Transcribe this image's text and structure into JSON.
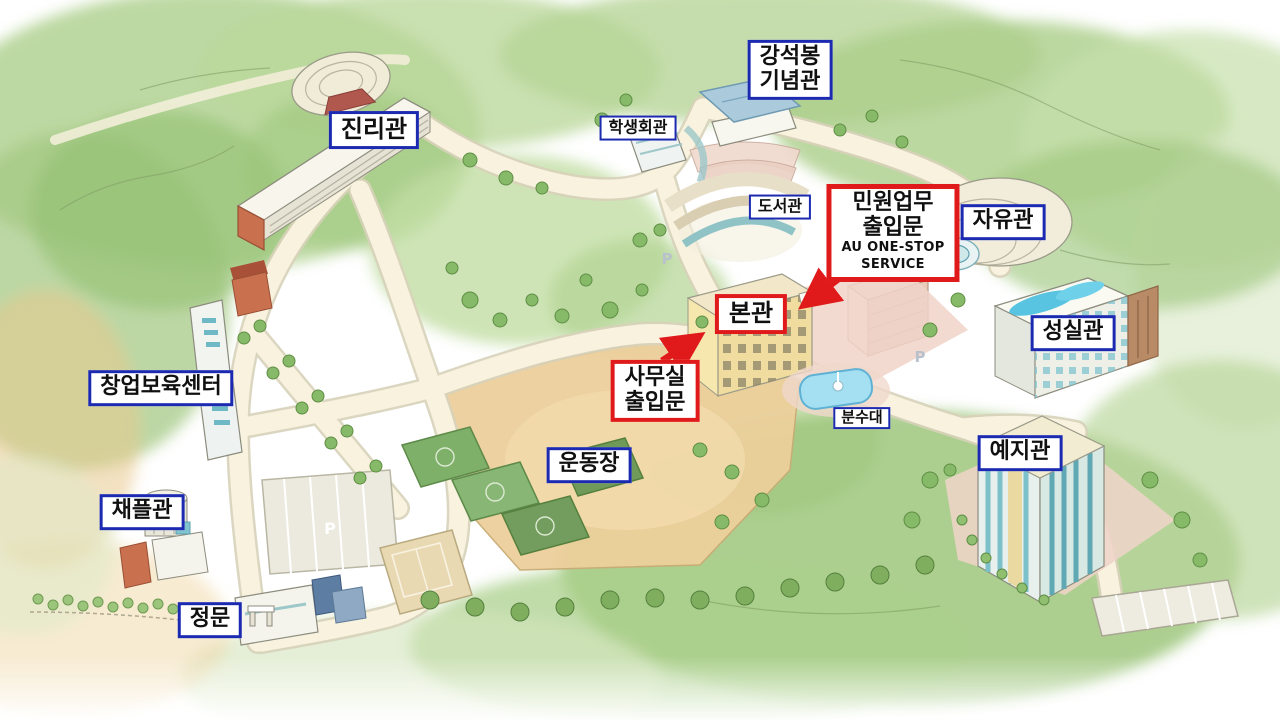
{
  "map": {
    "labels": {
      "jinrigwan": "진리관",
      "gangseokbong_line1": "강석봉",
      "gangseokbong_line2": "기념관",
      "haksaenghoegwan": "학생회관",
      "doseogwan": "도서관",
      "minwon_line1": "민원업무",
      "minwon_line2": "출입문",
      "minwon_line3": "AU ONE-STOP",
      "minwon_line4": "SERVICE",
      "jayugwan": "자유관",
      "bongwan": "본관",
      "seongsilgwan": "성실관",
      "samusil_line1": "사무실",
      "samusil_line2": "출입문",
      "bunsudae": "분수대",
      "undongjang": "운동장",
      "yejigwan": "예지관",
      "changeopboyukcenter": "창업보육센터",
      "chaepeulgwan": "채플관",
      "jeongmun": "정문"
    },
    "markers": {
      "parking": "P"
    },
    "colors": {
      "blue_label_border": "#1b2ab0",
      "red_label_border": "#e01a1a",
      "label_background": "#ffffff",
      "label_text": "#101010",
      "arrow": "#e01a1a"
    }
  }
}
